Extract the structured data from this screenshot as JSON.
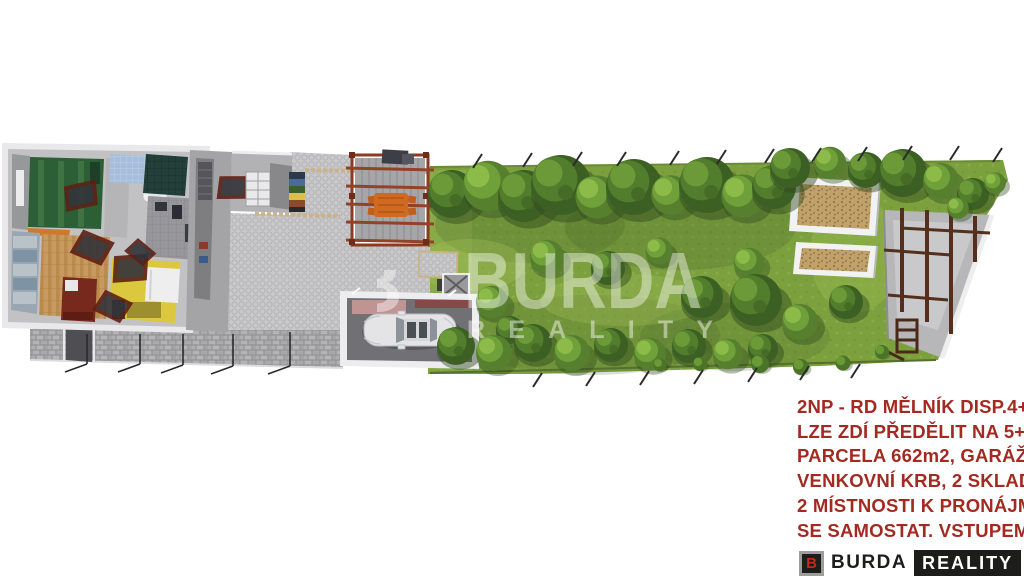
{
  "watermark": {
    "line1": "BURDA",
    "line2": "REALITY",
    "partial_letter": "B",
    "color": "#ffffff"
  },
  "caption": {
    "color": "#a32a21",
    "lines": [
      "2NP - RD MĚLNÍK DISP.4+1",
      "LZE ZDÍ PŘEDĚLIT NA 5+1",
      "PARCELA 662m2, GARÁŽ,",
      "VENKOVNÍ KRB, 2 SKLADY",
      "2 MÍSTNOSTI K PRONÁJMU",
      "SE SAMOSTAT. VSTUPEM"
    ]
  },
  "logo": {
    "icon_letter": "B",
    "name": "BURDA",
    "suffix": "REALITY",
    "icon_bg": "#1d1d1b",
    "icon_border": "#9d9d9c",
    "icon_letter_color": "#c7261b",
    "suffix_bg": "#1d1d1b",
    "suffix_color": "#ffffff"
  },
  "scene": {
    "type": "aerial-3d-site-plan-render",
    "features": [
      "house-upper-floor-cutaway",
      "open-roof-windows",
      "paved-courtyard",
      "pergola-with-outdoor-table",
      "outdoor-fireplace",
      "garage-with-car",
      "stone-wall-with-gate",
      "garden-lawn",
      "tree-rows",
      "two-raised-garden-beds",
      "storage-structure-frame",
      "boundary-fence-posts"
    ],
    "colors": {
      "grass": "#7da03f",
      "tree_dark": "#3c5f24",
      "tree_light": "#6fa03a",
      "pavement": "#c9c9cb",
      "pergola_wood": "#8c3a22",
      "table_orange": "#d06a20",
      "mulch_bed": "#c0a169",
      "roof_window_frame": "#5e2015",
      "room_green": "#2d5f37",
      "room_yellow": "#dcc83e",
      "room_wood": "#c79a5f",
      "stone_wall": "#a3a3a5",
      "car_body": "#e4e4e6"
    }
  }
}
